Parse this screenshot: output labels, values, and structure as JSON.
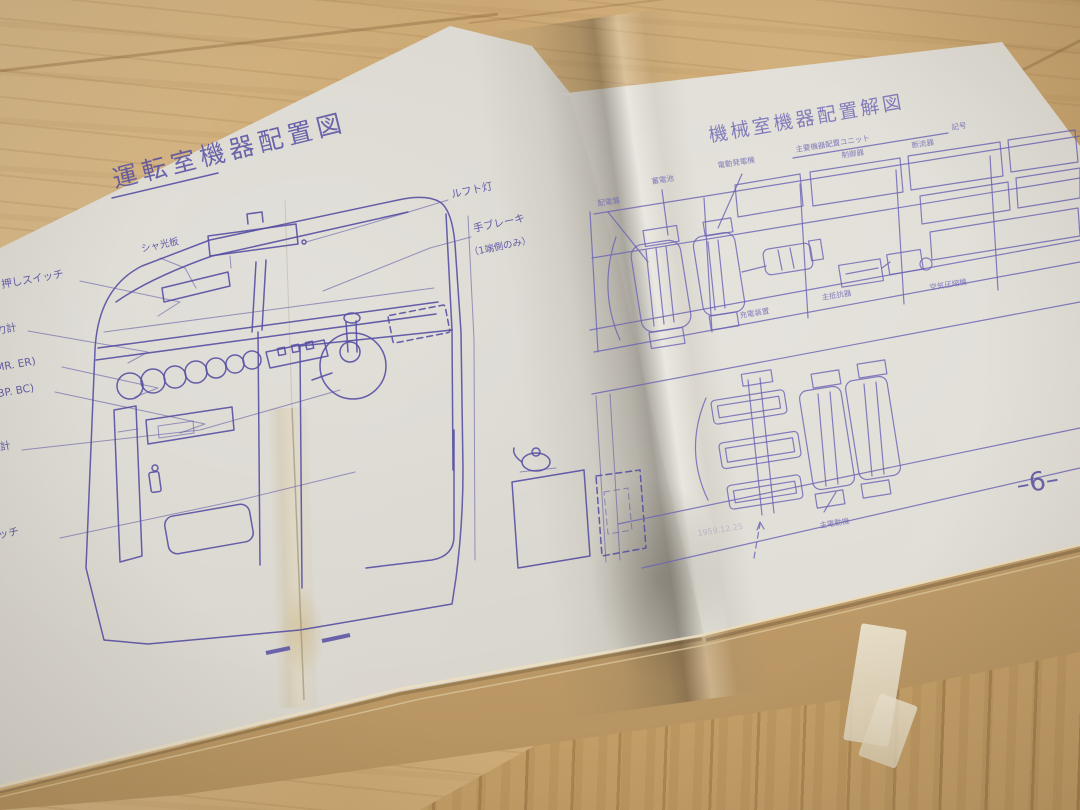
{
  "left_page": {
    "title": "運転室機器配置図",
    "labels": {
      "sun_visor": "シャ光板",
      "roof_light": "ルフト灯",
      "hand_brake": "手ブレーキ",
      "hand_brake_note": "（1端側のみ）",
      "push_switch": "押しスイッチ",
      "pressure_gauge": "圧力計",
      "gauge_mr_er": "(MR. ER)",
      "gauge_bp_bc": "(BP. BC)",
      "ammeter": "電流計",
      "switch": "スイッチ"
    }
  },
  "right_page": {
    "title": "機械室機器配置解図",
    "page_number": "–6–",
    "labels": {
      "distribution_panel": "配電盤",
      "battery": "蓄電池",
      "motor_generator": "電動発電機",
      "controller": "制御器",
      "breaker": "断流器",
      "main_resistor": "主抵抗器",
      "compressor": "空気圧縮機",
      "charger": "充電装置",
      "traction_motor": "主電動機",
      "layout_note": "主要機器配置ユニット",
      "symbol_note": "記号",
      "faint_note": "1959.12.25"
    }
  },
  "colors": {
    "ink": "#564fa2",
    "ink_light": "#6b64b4",
    "paper_left": "#d8d5ce",
    "paper_right": "#dedbd4",
    "kraft": "#c2a273",
    "wood": "#cfad7c"
  }
}
